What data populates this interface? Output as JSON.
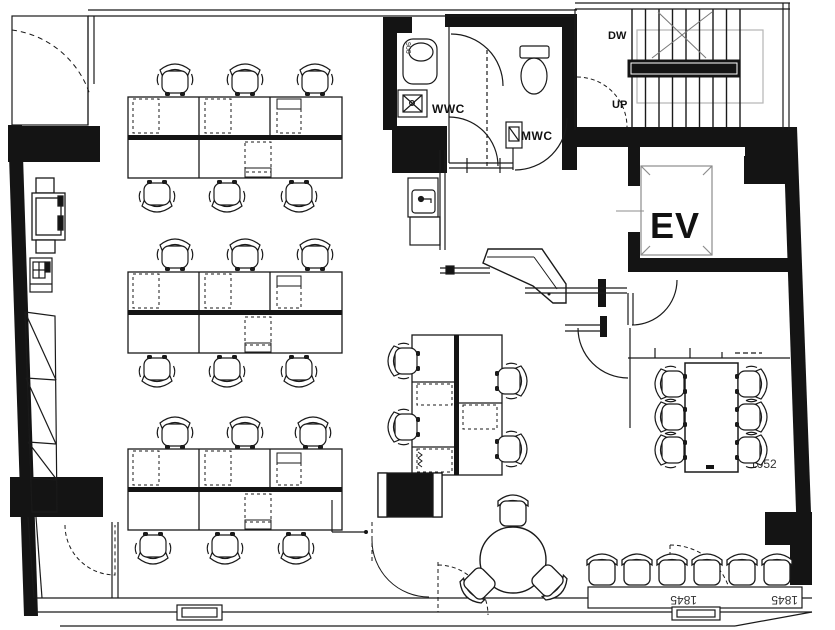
{
  "drawing": {
    "type": "architectural-floor-plan",
    "description": "Office floor plan with open desk area, WCs, stair, elevator and meeting area"
  },
  "labels": {
    "womens_wc": "WWC",
    "mens_wc": "MWC",
    "elevator": "EV",
    "stair_down": "DW",
    "stair_up": "UP",
    "dim_sink": "900",
    "dim_meeting": "1052",
    "dim_door_a": "1845",
    "dim_door_b": "1845"
  },
  "colors": {
    "line": "#1a1a1a",
    "wall_fill": "#141414",
    "light_line": "#9a9a9a",
    "background": "#ffffff"
  }
}
